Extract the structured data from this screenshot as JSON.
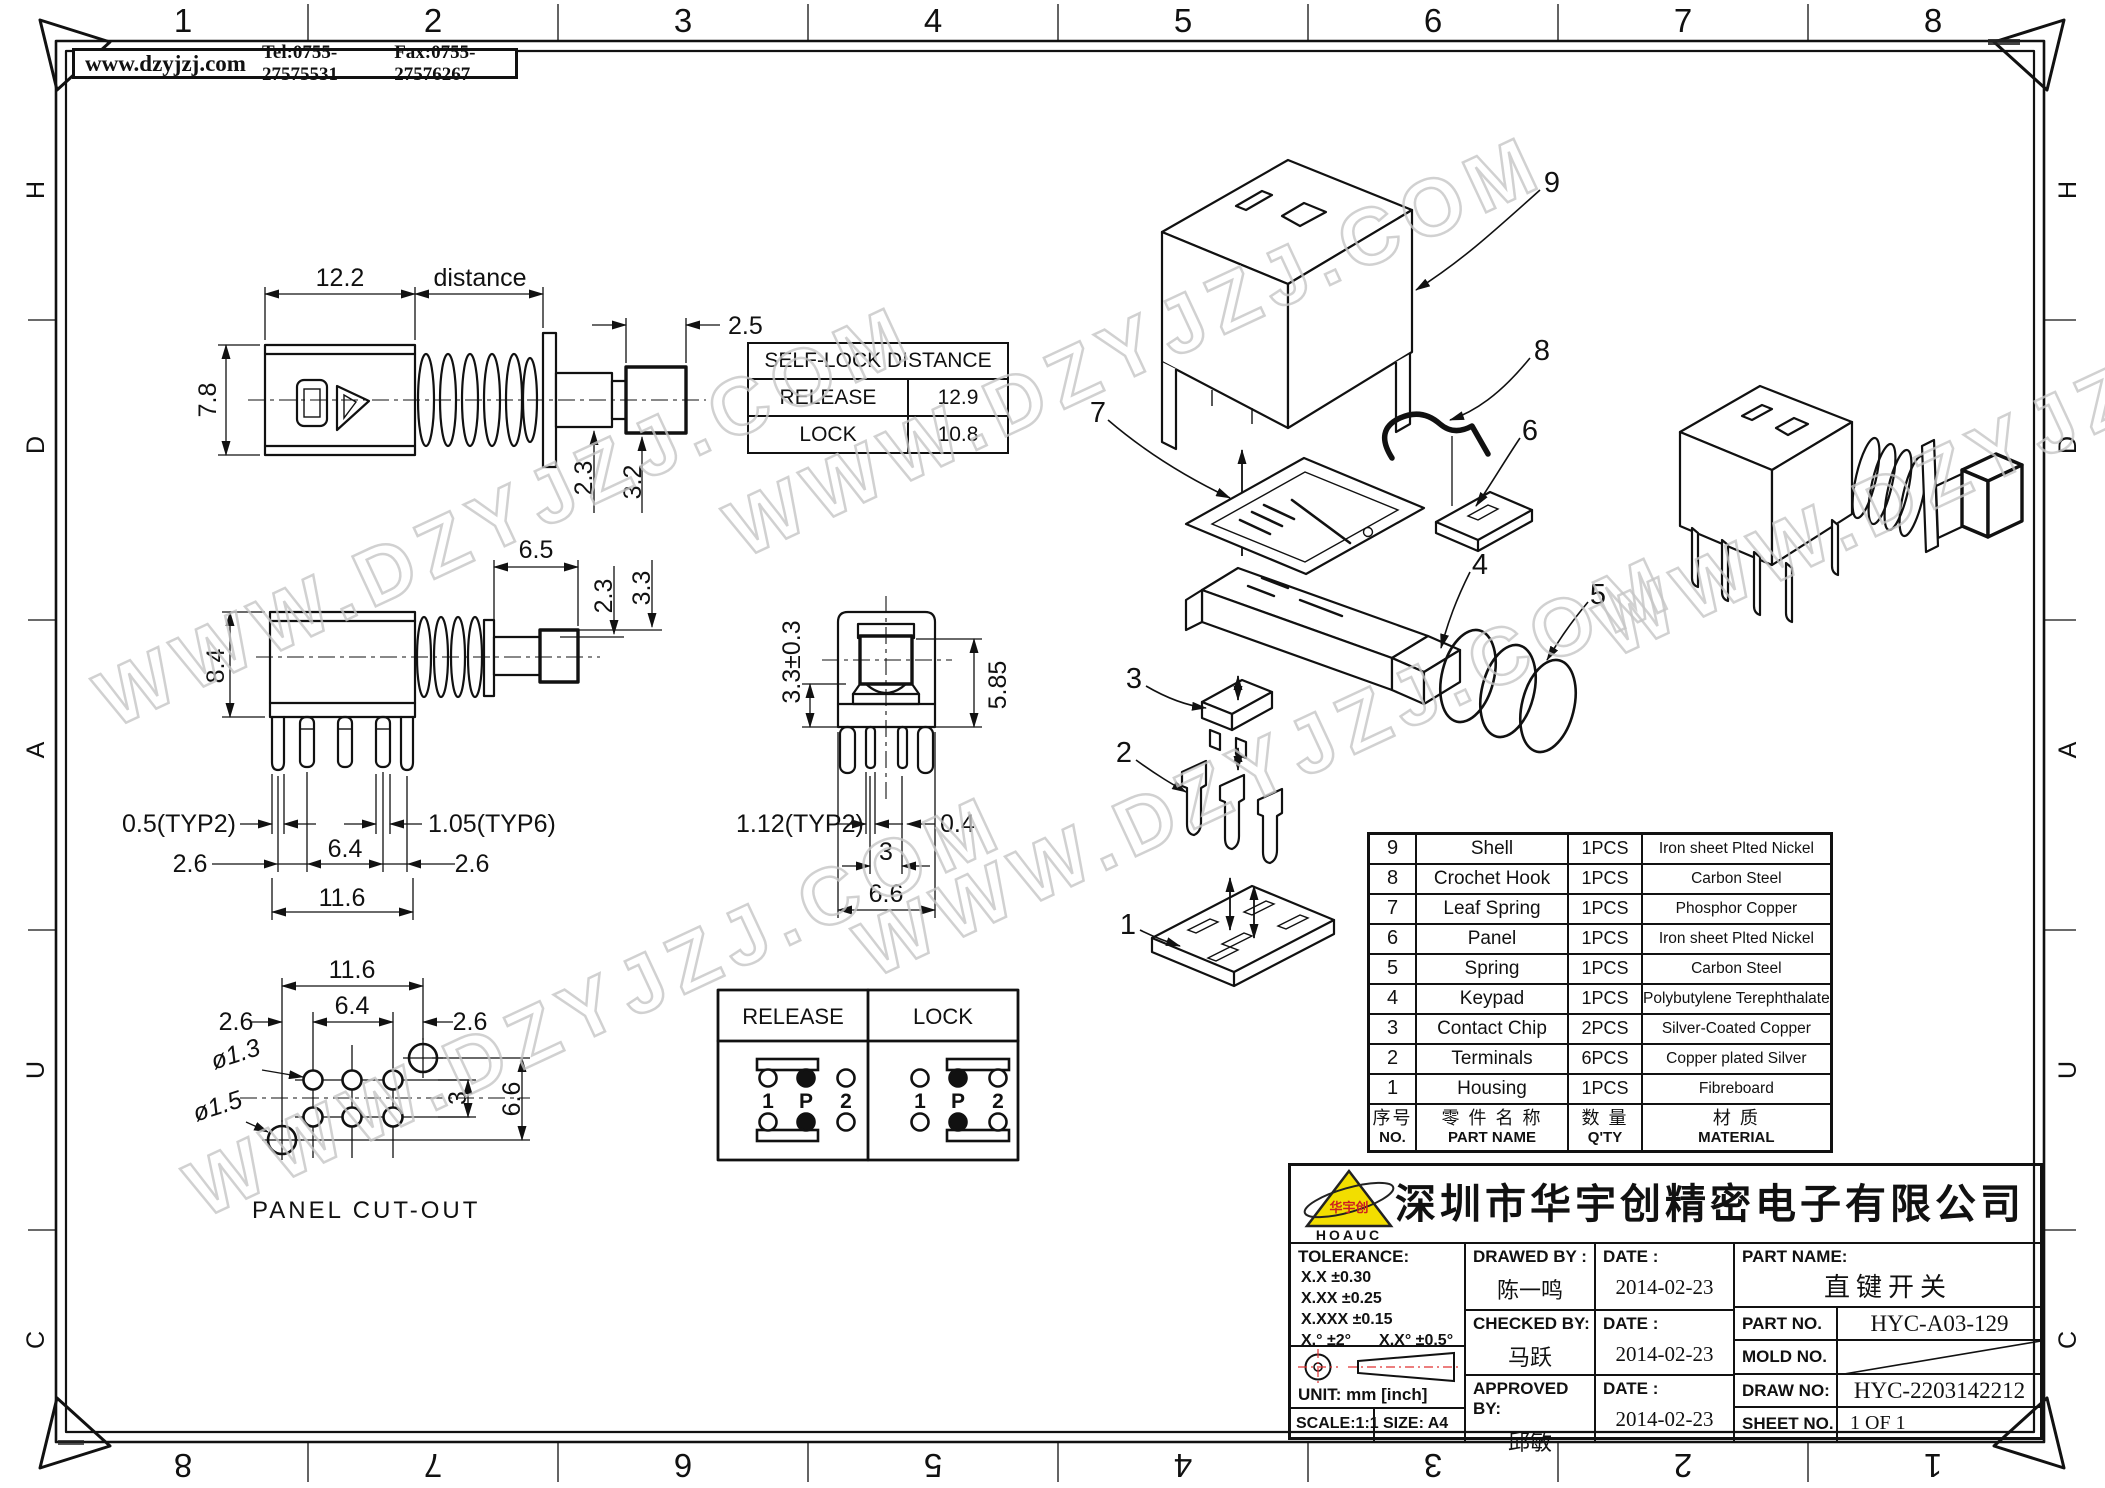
{
  "frame": {
    "top": [
      "1",
      "2",
      "3",
      "4",
      "5",
      "6",
      "7",
      "8"
    ],
    "bottom": [
      "8",
      "7",
      "6",
      "5",
      "4",
      "3",
      "2",
      "1"
    ],
    "left": [
      "H",
      "D",
      "A",
      "U",
      "C"
    ],
    "right": [
      "H",
      "D",
      "A",
      "U",
      "C"
    ]
  },
  "header": {
    "site": "www.dzyjzj.com",
    "tel": "Tel:0755-27575531",
    "fax": "Fax:0755-27576267"
  },
  "watermark": "WWW.DZYJZJ.COM",
  "locktable": {
    "title": "SELF-LOCK DISTANCE",
    "r1l": "RELEASE",
    "r1v": "12.9",
    "r2l": "LOCK",
    "r2v": "10.8"
  },
  "v1": {
    "w": "12.2",
    "dist": "distance",
    "btn": "2.5",
    "h": "7.8",
    "shaft": "2.3",
    "btnh": "3.2"
  },
  "v2": {
    "a": "6.5",
    "b": "2.3",
    "c": "3.3",
    "h": "8.4",
    "t2": "0.5(TYP2)",
    "t6": "1.05(TYP6)",
    "l": "2.6",
    "m": "6.4",
    "r": "2.6",
    "w": "11.6"
  },
  "v3": {
    "a": "3.3±0.3",
    "b": "5.85",
    "t2": "1.12(TYP2)",
    "c": "0.4",
    "d": "3",
    "w": "6.6"
  },
  "pc": {
    "title": "PANEL CUT-OUT",
    "w": "11.6",
    "l": "2.6",
    "m": "6.4",
    "r": "2.6",
    "d1": "ø1.3",
    "d2": "ø1.5",
    "row": "3",
    "h": "6.6"
  },
  "circ": {
    "rel": "RELEASE",
    "lock": "LOCK",
    "p1": "1",
    "p2": "P",
    "p3": "2"
  },
  "callouts": [
    "1",
    "2",
    "3",
    "4",
    "5",
    "6",
    "7",
    "8",
    "9"
  ],
  "bom": {
    "h": {
      "no1": "序号",
      "no2": "NO.",
      "n1": "零 件 名 称",
      "n2": "PART NAME",
      "q1": "数 量",
      "q2": "Q'TY",
      "m1": "材 质",
      "m2": "MATERIAL"
    },
    "rows": [
      {
        "no": "9",
        "name": "Shell",
        "qty": "1PCS",
        "material": "Iron sheet Plted Nickel"
      },
      {
        "no": "8",
        "name": "Crochet Hook",
        "qty": "1PCS",
        "material": "Carbon Steel"
      },
      {
        "no": "7",
        "name": "Leaf Spring",
        "qty": "1PCS",
        "material": "Phosphor Copper"
      },
      {
        "no": "6",
        "name": "Panel",
        "qty": "1PCS",
        "material": "Iron sheet Plted Nickel"
      },
      {
        "no": "5",
        "name": "Spring",
        "qty": "1PCS",
        "material": "Carbon Steel"
      },
      {
        "no": "4",
        "name": "Keypad",
        "qty": "1PCS",
        "material": "Polybutylene Terephthalate"
      },
      {
        "no": "3",
        "name": "Contact Chip",
        "qty": "2PCS",
        "material": "Silver-Coated Copper"
      },
      {
        "no": "2",
        "name": "Terminals",
        "qty": "6PCS",
        "material": "Copper plated Silver"
      },
      {
        "no": "1",
        "name": "Housing",
        "qty": "1PCS",
        "material": "Fibreboard"
      }
    ]
  },
  "tb": {
    "company": "深圳市华宇创精密电子有限公司",
    "logo_en": "HOAUC",
    "logo_cn": "华宇创",
    "tol_label": "TOLERANCE:",
    "tol1": "X.X    ±0.30",
    "tol2": "X.XX   ±0.25",
    "tol3": "X.XXX  ±0.15",
    "tol4": "X.°  ±2°",
    "tol5": "X.X°  ±0.5°",
    "unit": "UNIT:  mm  [inch]",
    "scale": "SCALE:1:1",
    "size": "SIZE:  A4",
    "drawed_label": "DRAWED  BY :",
    "drawed_name": "陈一鸣",
    "checked_label": "CHECKED  BY:",
    "checked_name": "马跃",
    "approved_label": "APPROVED  BY:",
    "approved_name": "邱敏",
    "date_label": "DATE :",
    "date1": "2014-02-23",
    "date2": "2014-02-23",
    "date3": "2014-02-23",
    "pname_label": "PART  NAME:",
    "pname": "直键开关",
    "pno_label": "PART  NO.",
    "pno": "HYC-A03-129",
    "mold_label": "MOLD  NO.",
    "draw_label": "DRAW  NO:",
    "draw_no": "HYC-2203142212",
    "sheet_label": "SHEET  NO.",
    "sheet": "1 OF 1"
  },
  "colors": {
    "line": "#111111",
    "logo_yellow": "#f2de00",
    "logo_red": "#cc2020",
    "centerline_red": "#e03030",
    "watermark": "#c6c6c6"
  }
}
